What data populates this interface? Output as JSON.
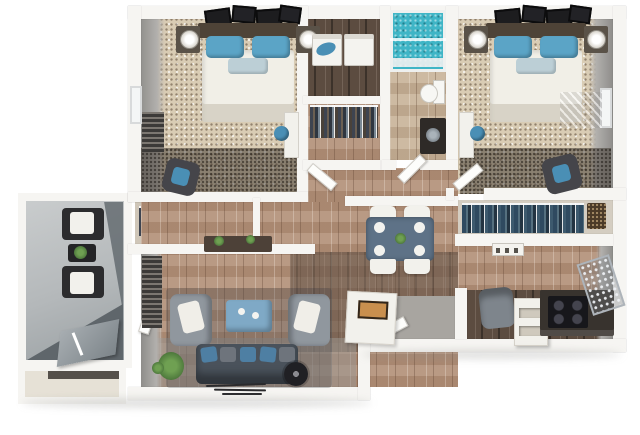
{
  "image": {
    "kind": "3d-rendered floor plan, top-down view",
    "visible_text": "none (a tiny unreadable label sign sits on the kitchen island)"
  },
  "colors": {
    "background": "#ffffff",
    "wall": "#f6f5f2",
    "wall_face": "#8e8d8a",
    "carpet": "#d9ccb4",
    "wood": "#b3917a",
    "wood_dark": "#5c4c40",
    "counter_dark": "#38332e",
    "cabinet_white": "#f2f1ec",
    "concrete": "#b4b8ba",
    "concrete_shadow": "#5f666b",
    "shower": "#3fb5c6",
    "duvet": "#f1efe7",
    "headboard": "#4e4337",
    "pillow_blue": "#5ba4c6",
    "accent_pillow": "#bccfd6",
    "sofa": "#4a525b",
    "sofa_pillow_blue": "#4e7fa3",
    "sofa_pillow_gray": "#6e747c",
    "armchair": "#90979e",
    "coffee_table": "#7fa9c6",
    "dining_table": "#5e7287",
    "stool_blue": "#4a8fb5",
    "plant": "#4f7a3d",
    "sign": "#c98f4e",
    "nightstand": "#5a5248",
    "entry_floor": "#a8a5a0",
    "storage_floor": "#e6e1d6"
  },
  "rooms": {
    "bedroom1": {
      "name": "Bedroom 1 (top-left): bed with blue pillows, nightstands with lamps, wall art, window, dresser, accent chair, vanity desk with blue stool"
    },
    "laundry": {
      "name": "Laundry closet: washer and dryer side by side"
    },
    "closet1": {
      "name": "Walk-in closet with hanging clothes"
    },
    "bathroom": {
      "name": "Bathroom: teal tiled shower, toilet, dark vanity with sink"
    },
    "bedroom2": {
      "name": "Bedroom 2 (top-right): bed with blue pillows, nightstands with lamps, wall art, window with blinds, accent chair, vanity desk with blue stool"
    },
    "hall_closet": {
      "name": "Hall closet with hanging clothes"
    },
    "utility": {
      "name": "Utility closet with water heater"
    },
    "closet2": {
      "name": "Bedroom 2 closet with hanging clothes and basket"
    },
    "hallway": {
      "name": "Hallway with open doors"
    },
    "living": {
      "name": "Living room: two gray armchairs, blue ottoman coffee table, dark sofa with blue pillows, plant, fan, console table"
    },
    "dining": {
      "name": "Dining area: table with four white chairs and place settings"
    },
    "kitchen": {
      "name": "Kitchen: island with label sign, shelving island, desk chair, dark counter with black range, drying rack"
    },
    "entry": {
      "name": "Entry with door"
    },
    "balcony": {
      "name": "Balcony/patio: two dark chairs with white cushions, plant table, leaning board"
    },
    "storage": {
      "name": "Patio storage room"
    }
  }
}
